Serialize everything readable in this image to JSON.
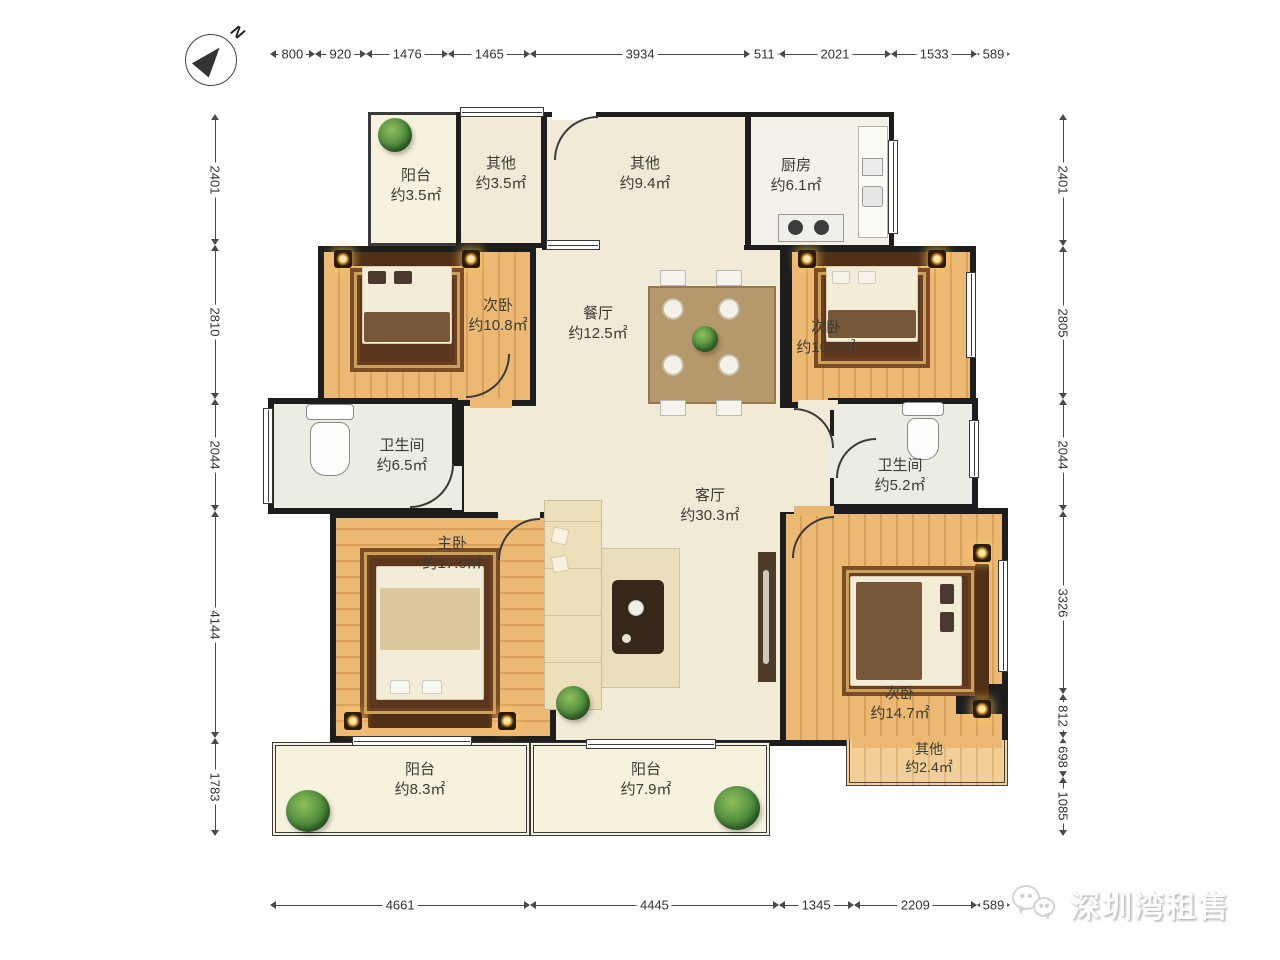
{
  "compass": {
    "label": "N"
  },
  "dimensions": {
    "top": [
      "800",
      "920",
      "1476",
      "1465",
      "3934",
      "511",
      "2021",
      "1533",
      "589"
    ],
    "bottom": [
      "4661",
      "4445",
      "1345",
      "2209",
      "589"
    ],
    "left": [
      "2401",
      "2810",
      "2044",
      "4144",
      "1783"
    ],
    "right": [
      "2401",
      "2805",
      "2044",
      "3326",
      "812",
      "698",
      "1085"
    ]
  },
  "rooms": {
    "balcony_tl": {
      "name": "阳台",
      "area": "约3.5㎡"
    },
    "other_tl": {
      "name": "其他",
      "area": "约3.5㎡"
    },
    "hall": {
      "name": "其他",
      "area": "约9.4㎡"
    },
    "kitchen": {
      "name": "厨房",
      "area": "约6.1㎡"
    },
    "bedroom_left": {
      "name": "次卧",
      "area": "约10.8㎡"
    },
    "dining": {
      "name": "餐厅",
      "area": "约12.5㎡"
    },
    "bedroom_right": {
      "name": "次卧",
      "area": "约10.0㎡"
    },
    "bath_left": {
      "name": "卫生间",
      "area": "约6.5㎡"
    },
    "bath_right": {
      "name": "卫生间",
      "area": "约5.2㎡"
    },
    "master": {
      "name": "主卧",
      "area": "约17.6㎡"
    },
    "living": {
      "name": "客厅",
      "area": "约30.3㎡"
    },
    "bedroom_br": {
      "name": "次卧",
      "area": "约14.7㎡"
    },
    "other_br": {
      "name": "其他",
      "area": "约2.4㎡"
    },
    "balcony_bl": {
      "name": "阳台",
      "area": "约8.3㎡"
    },
    "balcony_bc": {
      "name": "阳台",
      "area": "约7.9㎡"
    }
  },
  "watermark": {
    "text": "深圳湾租售"
  },
  "colors": {
    "wall": "#1d1d1d",
    "wood": "#ecb975",
    "floor_cream": "#f0ead7",
    "plant_green": "#4c8a3c"
  }
}
